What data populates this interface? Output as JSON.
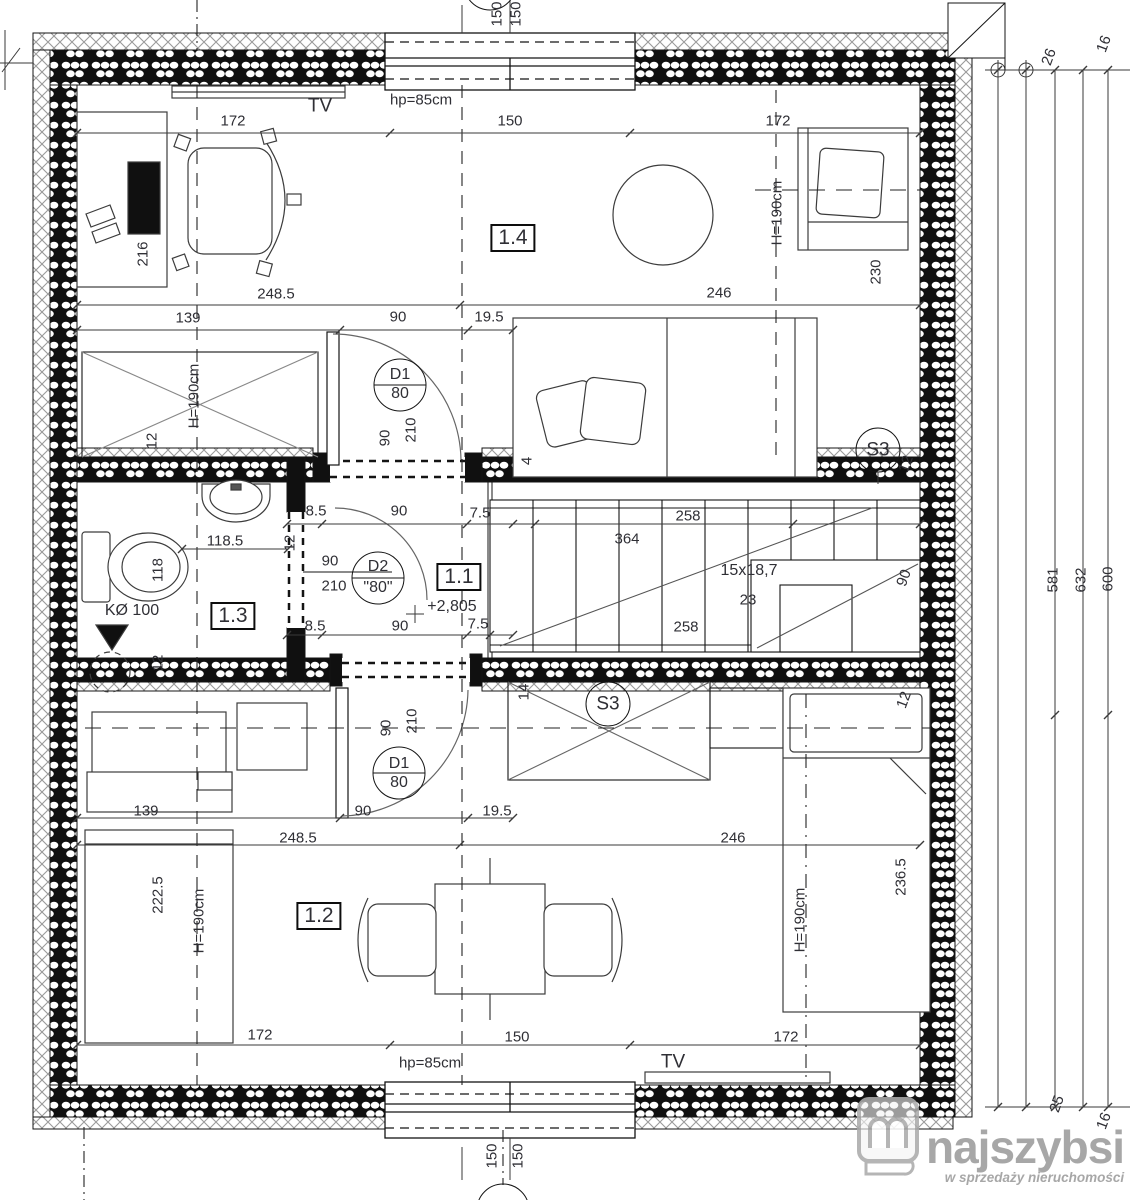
{
  "colors": {
    "line": "#141414",
    "dim_text": "#2f2f35",
    "logo_gray": "#9b9b9b",
    "hatch": "#9a9a9a",
    "furniture": "#3c3c3c"
  },
  "logo": {
    "brand": "najszybsi",
    "tagline": "w sprzedaży nieruchomości"
  },
  "rooms": [
    {
      "id": "1.1",
      "type": "hall-staircase"
    },
    {
      "id": "1.2",
      "type": "room-bottom"
    },
    {
      "id": "1.3",
      "type": "bathroom"
    },
    {
      "id": "1.4",
      "type": "room-top"
    }
  ],
  "annotations": [
    {
      "n": "axis-label-150-top-a",
      "t": "150",
      "x": 497,
      "y": 14,
      "r": -90
    },
    {
      "n": "axis-label-150-top-b",
      "t": "150",
      "x": 516,
      "y": 14,
      "r": -90
    },
    {
      "n": "tv-label-top",
      "t": "TV",
      "x": 320,
      "y": 106,
      "s": 19
    },
    {
      "n": "parapet-label-top",
      "t": "hp=85cm",
      "x": 421,
      "y": 100
    },
    {
      "n": "dim-172-top-left",
      "t": "172",
      "x": 233,
      "y": 121
    },
    {
      "n": "dim-150-top",
      "t": "150",
      "x": 510,
      "y": 121
    },
    {
      "n": "dim-172-top-right",
      "t": "172",
      "x": 778,
      "y": 121
    },
    {
      "n": "dim-216",
      "t": "216",
      "x": 143,
      "y": 254,
      "r": -90
    },
    {
      "n": "room-label-1-4",
      "t": "1.4",
      "x": 513,
      "y": 238,
      "b": 1
    },
    {
      "n": "dim-h190-room14-left",
      "t": "H=190cm",
      "x": 194,
      "y": 396,
      "r": -90
    },
    {
      "n": "dim-h190-room14-right",
      "t": "H=190cm",
      "x": 777,
      "y": 213,
      "r": -90
    },
    {
      "n": "dim-230",
      "t": "230",
      "x": 876,
      "y": 272,
      "r": -90
    },
    {
      "n": "dim-248-5-top",
      "t": "248.5",
      "x": 276,
      "y": 294
    },
    {
      "n": "dim-246-top",
      "t": "246",
      "x": 719,
      "y": 293
    },
    {
      "n": "dim-139-top",
      "t": "139",
      "x": 188,
      "y": 318
    },
    {
      "n": "dim-90-top",
      "t": "90",
      "x": 398,
      "y": 317
    },
    {
      "n": "dim-19-5-top",
      "t": "19.5",
      "x": 489,
      "y": 317
    },
    {
      "n": "door-tag-d1-top",
      "t": "D1",
      "x": 400,
      "y": 375,
      "s": 16
    },
    {
      "n": "door-tag-d1-top-size",
      "t": "80",
      "x": 400,
      "y": 394,
      "s": 16
    },
    {
      "n": "dim-90-door-top",
      "t": "90",
      "x": 385,
      "y": 438,
      "r": -90
    },
    {
      "n": "dim-210-door-top",
      "t": "210",
      "x": 411,
      "y": 430,
      "r": -90
    },
    {
      "n": "dim-12-left-top",
      "t": "12",
      "x": 152,
      "y": 441,
      "r": -90
    },
    {
      "n": "dim-4-bed",
      "t": "4",
      "x": 527,
      "y": 461,
      "r": -90
    },
    {
      "n": "skylight-tag-s3-right",
      "t": "S3",
      "x": 878,
      "y": 450,
      "s": 19
    },
    {
      "n": "dim-12-s3-right",
      "t": "12",
      "x": 906,
      "y": 464,
      "r": -70
    },
    {
      "n": "dim-8-5-mid-top",
      "t": "8.5",
      "x": 316,
      "y": 511
    },
    {
      "n": "dim-90-mid-top",
      "t": "90",
      "x": 399,
      "y": 511
    },
    {
      "n": "dim-7-5-mid-top",
      "t": "7.5",
      "x": 480,
      "y": 513
    },
    {
      "n": "dim-258-stairs-top",
      "t": "258",
      "x": 688,
      "y": 516
    },
    {
      "n": "dim-364-stairs",
      "t": "364",
      "x": 627,
      "y": 539
    },
    {
      "n": "dim-118-5",
      "t": "118.5",
      "x": 225,
      "y": 541
    },
    {
      "n": "dim-12-partition",
      "t": "12",
      "x": 290,
      "y": 543,
      "r": -90
    },
    {
      "n": "dim-90-door-d2",
      "t": "90",
      "x": 330,
      "y": 561
    },
    {
      "n": "dim-210-door-d2",
      "t": "210",
      "x": 334,
      "y": 586
    },
    {
      "n": "door-tag-d2",
      "t": "D2",
      "x": 378,
      "y": 567,
      "s": 16
    },
    {
      "n": "door-tag-d2-size",
      "t": "\"80\"",
      "x": 378,
      "y": 588,
      "s": 16
    },
    {
      "n": "room-label-1-1",
      "t": "1.1",
      "x": 459,
      "y": 577,
      "b": 1
    },
    {
      "n": "level-mark",
      "t": "+2,805",
      "x": 452,
      "y": 607,
      "s": 16
    },
    {
      "n": "dim-stairs-steps",
      "t": "15x18,7",
      "x": 749,
      "y": 571,
      "s": 16
    },
    {
      "n": "dim-23-stairs",
      "t": "23",
      "x": 748,
      "y": 600
    },
    {
      "n": "dim-258-stairs-bottom",
      "t": "258",
      "x": 686,
      "y": 627
    },
    {
      "n": "dim-90-stairs",
      "t": "90",
      "x": 904,
      "y": 578,
      "r": -70
    },
    {
      "n": "drain-label",
      "t": "KØ 100",
      "x": 132,
      "y": 611,
      "s": 16
    },
    {
      "n": "dim-118",
      "t": "118",
      "x": 158,
      "y": 570,
      "r": -90
    },
    {
      "n": "room-label-1-3",
      "t": "1.3",
      "x": 233,
      "y": 616,
      "b": 1
    },
    {
      "n": "dim-12-bath",
      "t": "12",
      "x": 158,
      "y": 663,
      "r": -90
    },
    {
      "n": "dim-8-5-mid-bottom",
      "t": "8.5",
      "x": 315,
      "y": 626
    },
    {
      "n": "dim-90-mid-bottom",
      "t": "90",
      "x": 400,
      "y": 626
    },
    {
      "n": "dim-7-5-mid-bottom",
      "t": "7.5",
      "x": 478,
      "y": 624
    },
    {
      "n": "dim-14-s3-mid",
      "t": "14",
      "x": 524,
      "y": 692,
      "r": -90
    },
    {
      "n": "skylight-tag-s3-mid",
      "t": "S3",
      "x": 608,
      "y": 704,
      "s": 19
    },
    {
      "n": "dim-12-right-mid",
      "t": "12",
      "x": 904,
      "y": 700,
      "r": -70
    },
    {
      "n": "dim-90-door-bottom",
      "t": "90",
      "x": 386,
      "y": 728,
      "r": -90
    },
    {
      "n": "dim-210-door-bottom",
      "t": "210",
      "x": 412,
      "y": 721,
      "r": -90
    },
    {
      "n": "door-tag-d1-bottom",
      "t": "D1",
      "x": 399,
      "y": 764,
      "s": 16
    },
    {
      "n": "door-tag-d1-bottom-size",
      "t": "80",
      "x": 399,
      "y": 783,
      "s": 16
    },
    {
      "n": "dim-139-bottom",
      "t": "139",
      "x": 146,
      "y": 811
    },
    {
      "n": "dim-90-bottom",
      "t": "90",
      "x": 363,
      "y": 811
    },
    {
      "n": "dim-19-5-bottom",
      "t": "19.5",
      "x": 497,
      "y": 811
    },
    {
      "n": "dim-248-5-bottom",
      "t": "248.5",
      "x": 298,
      "y": 838
    },
    {
      "n": "dim-246-bottom",
      "t": "246",
      "x": 733,
      "y": 838
    },
    {
      "n": "dim-222-5",
      "t": "222.5",
      "x": 158,
      "y": 895,
      "r": -90
    },
    {
      "n": "dim-h190-room12-left",
      "t": "H=190cm",
      "x": 199,
      "y": 921,
      "r": -90
    },
    {
      "n": "room-label-1-2",
      "t": "1.2",
      "x": 319,
      "y": 916,
      "b": 1
    },
    {
      "n": "dim-236-5",
      "t": "236.5",
      "x": 901,
      "y": 877,
      "r": -90
    },
    {
      "n": "dim-h190-room12-right",
      "t": "H=190cm",
      "x": 800,
      "y": 920,
      "r": -90
    },
    {
      "n": "dim-172-bottom-left",
      "t": "172",
      "x": 260,
      "y": 1035
    },
    {
      "n": "dim-150-bottom",
      "t": "150",
      "x": 517,
      "y": 1037
    },
    {
      "n": "dim-172-bottom-right",
      "t": "172",
      "x": 786,
      "y": 1037
    },
    {
      "n": "parapet-label-bottom",
      "t": "hp=85cm",
      "x": 430,
      "y": 1063
    },
    {
      "n": "tv-label-bottom",
      "t": "TV",
      "x": 673,
      "y": 1062,
      "s": 19
    },
    {
      "n": "axis-label-150-bottom-a",
      "t": "150",
      "x": 492,
      "y": 1156,
      "r": -90
    },
    {
      "n": "axis-label-150-bottom-b",
      "t": "150",
      "x": 518,
      "y": 1156,
      "r": -90
    },
    {
      "n": "dim-26-top-right",
      "t": "26",
      "x": 1049,
      "y": 57,
      "r": -70
    },
    {
      "n": "dim-16-top-right",
      "t": "16",
      "x": 1104,
      "y": 44,
      "r": -70
    },
    {
      "n": "dim-581",
      "t": "581",
      "x": 1053,
      "y": 580,
      "r": -90
    },
    {
      "n": "dim-632",
      "t": "632",
      "x": 1081,
      "y": 580,
      "r": -90
    },
    {
      "n": "dim-600",
      "t": "600",
      "x": 1108,
      "y": 579,
      "r": -90
    },
    {
      "n": "dim-25-bottom-right",
      "t": "25",
      "x": 1057,
      "y": 1104,
      "r": -70
    },
    {
      "n": "dim-16-bottom-right",
      "t": "16",
      "x": 1104,
      "y": 1121,
      "r": -70
    }
  ]
}
